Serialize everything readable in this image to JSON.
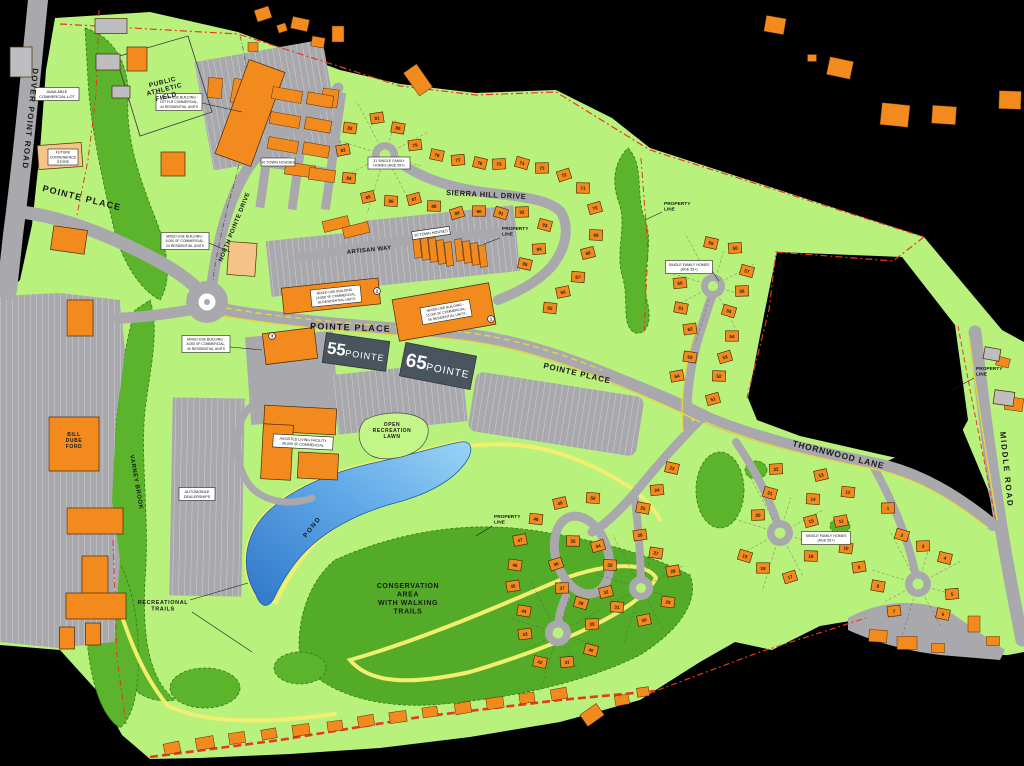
{
  "map_title": "Pointe Place Master Site Plan",
  "colors": {
    "background": "#000000",
    "site_green": "#b9f17d",
    "forest_green": "#5cb32c",
    "conservation_green": "#54ab28",
    "road_gray": "#a9a9ad",
    "stripe_white": "#d6d6da",
    "building_orange": "#f28a1e",
    "building_peach": "#f6c489",
    "building_gray": "#bdbdc2",
    "pond_blue_dark": "#2f77c8",
    "pond_blue_light": "#9bd4f5",
    "trail_yellow": "#f2ee70",
    "curb_yellow": "#e8d93a",
    "property_red": "#e8391f",
    "logo_slate": "#4a545e",
    "label_box": "#ffffff",
    "ink": "#1a1a1a"
  },
  "logos": [
    {
      "big": "55",
      "small": "POINTE",
      "x": 356,
      "y": 352,
      "w": 64,
      "h": 30,
      "rot": 8
    },
    {
      "big": "65",
      "small": "POINTE",
      "x": 438,
      "y": 366,
      "w": 72,
      "h": 34,
      "rot": 11
    }
  ],
  "road_labels": [
    {
      "id": "dover-point-road",
      "text": "DOVER POINT ROAD",
      "x": 33,
      "y": 68,
      "rot": 96,
      "size": 8,
      "ls": 1.3
    },
    {
      "id": "pointe-place-west",
      "text": "POINTE PLACE",
      "x": 42,
      "y": 191,
      "rot": 14,
      "size": 9,
      "ls": 1.2
    },
    {
      "id": "pointe-place-center",
      "text": "POINTE PLACE",
      "x": 310,
      "y": 329,
      "rot": 2,
      "size": 9,
      "ls": 1.2
    },
    {
      "id": "pointe-place-east",
      "text": "POINTE PLACE",
      "x": 543,
      "y": 368,
      "rot": 13,
      "size": 8,
      "ls": 0.8
    },
    {
      "id": "north-pointe-drive",
      "text": "NORTH POINTE DRIVE",
      "x": 222,
      "y": 262,
      "rot": -68,
      "size": 6,
      "ls": 0.5
    },
    {
      "id": "sierra-hill-drive",
      "text": "SIERRA HILL DRIVE",
      "x": 446,
      "y": 195,
      "rot": 3,
      "size": 7.5,
      "ls": 0.5
    },
    {
      "id": "artisan-way",
      "text": "ARTISAN WAY",
      "x": 347,
      "y": 254,
      "rot": -6,
      "size": 6,
      "ls": 0.3
    },
    {
      "id": "thornwood-lane",
      "text": "THORNWOOD LANE",
      "x": 792,
      "y": 446,
      "rot": 14,
      "size": 8.5,
      "ls": 0.8
    },
    {
      "id": "middle-road",
      "text": "MIDDLE ROAD",
      "x": 1000,
      "y": 432,
      "rot": 84,
      "size": 8,
      "ls": 1.8
    },
    {
      "id": "varney-brook",
      "text": "VARNEY BROOK",
      "x": 130,
      "y": 455,
      "rot": 80,
      "size": 6,
      "ls": 0.6
    },
    {
      "id": "pond",
      "text": "POND",
      "x": 306,
      "y": 538,
      "rot": -52,
      "size": 6.5,
      "ls": 1.5
    }
  ],
  "area_labels": [
    {
      "id": "public-athletic-field",
      "lines": [
        "PUBLIC",
        "ATHLETIC",
        "FIELD"
      ],
      "x": 163,
      "y": 84,
      "size": 6.5,
      "lh": 7.5,
      "rot": -14
    },
    {
      "id": "open-recreation-lawn",
      "lines": [
        "OPEN",
        "RECREATION",
        "LAWN"
      ],
      "x": 392,
      "y": 426,
      "size": 5,
      "lh": 6,
      "rot": 0
    },
    {
      "id": "conservation-area",
      "lines": [
        "CONSERVATION",
        "AREA",
        "WITH WALKING",
        "TRAILS"
      ],
      "x": 408,
      "y": 588,
      "size": 7,
      "lh": 8.5,
      "rot": 0
    },
    {
      "id": "recreational-trails",
      "lines": [
        "RECREATIONAL",
        "TRAILS"
      ],
      "x": 163,
      "y": 604,
      "size": 5.5,
      "lh": 6.5,
      "rot": 0
    },
    {
      "id": "bill-dube-ford",
      "lines": [
        "BILL",
        "DUBE",
        "FORD"
      ],
      "x": 74,
      "y": 436,
      "size": 5,
      "lh": 6,
      "rot": 0
    }
  ],
  "property_labels": [
    {
      "lines": [
        "PROPERTY",
        "LINE"
      ],
      "x": 664,
      "y": 205,
      "leader": [
        662,
        212,
        645,
        220
      ]
    },
    {
      "lines": [
        "PROPERTY",
        "LINE"
      ],
      "x": 502,
      "y": 230,
      "leader": [
        500,
        238,
        484,
        244
      ]
    },
    {
      "lines": [
        "PROPERTY",
        "LINE"
      ],
      "x": 494,
      "y": 518,
      "leader": [
        492,
        526,
        476,
        536
      ]
    },
    {
      "lines": [
        "PROPERTY",
        "LINE"
      ],
      "x": 976,
      "y": 370,
      "leader": [
        974,
        378,
        952,
        390
      ]
    }
  ],
  "boxed_labels": [
    {
      "id": "available-commercial-lot",
      "lines": [
        "AVAILABLE",
        "COMMERCIAL LOT"
      ],
      "x": 57,
      "y": 94,
      "w": 44,
      "h": 13,
      "s": 4,
      "rot": 0
    },
    {
      "id": "future-convenience-store",
      "lines": [
        "FUTURE",
        "CONVENIENCE",
        "STORE"
      ],
      "x": 63,
      "y": 157,
      "w": 30,
      "h": 16,
      "s": 3.6,
      "rot": 0
    },
    {
      "id": "mixed-use-44",
      "lines": [
        "MIXED-USE BUILDING -",
        "1ST FLR COMMERCIAL,",
        "44 RESIDENTIAL UNITS"
      ],
      "x": 179,
      "y": 102,
      "w": 46,
      "h": 17,
      "s": 3.4,
      "rot": 0
    },
    {
      "id": "sfh-31",
      "lines": [
        "31 SINGLE FAMILY",
        "HOMES (AGE 55+)"
      ],
      "x": 389,
      "y": 163,
      "w": 42,
      "h": 12,
      "s": 3.6,
      "rot": 0
    },
    {
      "id": "town-houses-10",
      "lines": [
        "10 TOWN HOUSES"
      ],
      "x": 278,
      "y": 162,
      "w": 34,
      "h": 8,
      "s": 3.8,
      "rot": 0
    },
    {
      "id": "town-houses-20",
      "lines": [
        "20 TOWN HOUSES"
      ],
      "x": 431,
      "y": 233,
      "w": 38,
      "h": 8,
      "s": 3.8,
      "rot": -8
    },
    {
      "id": "mixed-use-24",
      "lines": [
        "MIXED-USE BUILDING -",
        "5,000 SF COMMERCIAL,",
        "24 RESIDENTIAL UNITS"
      ],
      "x": 185,
      "y": 241,
      "w": 48,
      "h": 17,
      "s": 3.4,
      "rot": 0
    },
    {
      "id": "mixed-use-56-west",
      "lines": [
        "MIXED-USE BUILDING -",
        "15,000 SF COMMERCIAL,",
        "56 RESIDENTIAL UNITS"
      ],
      "x": 336,
      "y": 296,
      "w": 50,
      "h": 17,
      "s": 3.4,
      "rot": -6
    },
    {
      "id": "mixed-use-56-east",
      "lines": [
        "MIXED-USE BUILDING -",
        "15,000 SF COMMERCIAL,",
        "56 RESIDENTIAL UNITS"
      ],
      "x": 446,
      "y": 312,
      "w": 50,
      "h": 17,
      "s": 3.4,
      "rot": -10
    },
    {
      "id": "mixed-use-40",
      "lines": [
        "MIXED-USE BUILDING -",
        "8,000 SF COMMERCIAL,",
        "40 RESIDENTIAL UNITS"
      ],
      "x": 206,
      "y": 344,
      "w": 48,
      "h": 17,
      "s": 3.4,
      "rot": 0
    },
    {
      "id": "assisted-living",
      "lines": [
        "ASSISTED LIVING FACILITY",
        "38,000 SF COMMERCIAL"
      ],
      "x": 303,
      "y": 442,
      "w": 60,
      "h": 13,
      "s": 3.6,
      "rot": 3
    },
    {
      "id": "automobile-dealerships",
      "lines": [
        "AUTOMOBILE",
        "DEALERSHIPS"
      ],
      "x": 197,
      "y": 494,
      "w": 36,
      "h": 13,
      "s": 3.8,
      "rot": 0
    },
    {
      "id": "sfh-ne",
      "lines": [
        "SINGLE FAMILY HOMES",
        "(AGE 55+)"
      ],
      "x": 689,
      "y": 267,
      "w": 47,
      "h": 13,
      "s": 3.6,
      "rot": 0
    },
    {
      "id": "sfh-thornwood",
      "lines": [
        "SINGLE FAMILY HOMES",
        "(AGE 55+)"
      ],
      "x": 826,
      "y": 538,
      "w": 49,
      "h": 13,
      "s": 3.6,
      "rot": 0
    }
  ],
  "circled_numbers": [
    {
      "n": "1",
      "x": 491,
      "y": 319
    },
    {
      "n": "2",
      "x": 377,
      "y": 291
    },
    {
      "n": "3",
      "x": 272,
      "y": 336
    }
  ],
  "lots": [
    {
      "n": "1",
      "x": 888,
      "y": 508
    },
    {
      "n": "2",
      "x": 902,
      "y": 535
    },
    {
      "n": "3",
      "x": 923,
      "y": 546
    },
    {
      "n": "4",
      "x": 945,
      "y": 558
    },
    {
      "n": "5",
      "x": 952,
      "y": 594
    },
    {
      "n": "6",
      "x": 943,
      "y": 614
    },
    {
      "n": "7",
      "x": 894,
      "y": 611
    },
    {
      "n": "8",
      "x": 878,
      "y": 586
    },
    {
      "n": "9",
      "x": 859,
      "y": 567
    },
    {
      "n": "10",
      "x": 846,
      "y": 548
    },
    {
      "n": "11",
      "x": 841,
      "y": 521
    },
    {
      "n": "12",
      "x": 848,
      "y": 492
    },
    {
      "n": "13",
      "x": 821,
      "y": 475
    },
    {
      "n": "14",
      "x": 813,
      "y": 499
    },
    {
      "n": "15",
      "x": 811,
      "y": 521
    },
    {
      "n": "16",
      "x": 811,
      "y": 556
    },
    {
      "n": "17",
      "x": 790,
      "y": 577
    },
    {
      "n": "18",
      "x": 763,
      "y": 568
    },
    {
      "n": "19",
      "x": 745,
      "y": 556
    },
    {
      "n": "20",
      "x": 758,
      "y": 515
    },
    {
      "n": "21",
      "x": 770,
      "y": 493
    },
    {
      "n": "22",
      "x": 776,
      "y": 469
    },
    {
      "n": "23",
      "x": 672,
      "y": 468
    },
    {
      "n": "24",
      "x": 657,
      "y": 490
    },
    {
      "n": "25",
      "x": 643,
      "y": 508
    },
    {
      "n": "26",
      "x": 640,
      "y": 535
    },
    {
      "n": "27",
      "x": 656,
      "y": 553
    },
    {
      "n": "28",
      "x": 673,
      "y": 571
    },
    {
      "n": "29",
      "x": 668,
      "y": 602
    },
    {
      "n": "30",
      "x": 644,
      "y": 620
    },
    {
      "n": "31",
      "x": 617,
      "y": 607
    },
    {
      "n": "32",
      "x": 606,
      "y": 592
    },
    {
      "n": "33",
      "x": 610,
      "y": 565
    },
    {
      "n": "34",
      "x": 598,
      "y": 546
    },
    {
      "n": "35",
      "x": 573,
      "y": 541
    },
    {
      "n": "36",
      "x": 556,
      "y": 564
    },
    {
      "n": "37",
      "x": 562,
      "y": 588
    },
    {
      "n": "38",
      "x": 581,
      "y": 603
    },
    {
      "n": "39",
      "x": 592,
      "y": 624
    },
    {
      "n": "40",
      "x": 591,
      "y": 650
    },
    {
      "n": "41",
      "x": 567,
      "y": 662
    },
    {
      "n": "42",
      "x": 540,
      "y": 662
    },
    {
      "n": "43",
      "x": 525,
      "y": 634
    },
    {
      "n": "44",
      "x": 524,
      "y": 611
    },
    {
      "n": "45",
      "x": 513,
      "y": 586
    },
    {
      "n": "46",
      "x": 515,
      "y": 565
    },
    {
      "n": "47",
      "x": 520,
      "y": 540
    },
    {
      "n": "48",
      "x": 536,
      "y": 519
    },
    {
      "n": "49",
      "x": 560,
      "y": 503
    },
    {
      "n": "50",
      "x": 593,
      "y": 498
    },
    {
      "n": "51",
      "x": 713,
      "y": 399
    },
    {
      "n": "52",
      "x": 719,
      "y": 376
    },
    {
      "n": "53",
      "x": 725,
      "y": 357
    },
    {
      "n": "54",
      "x": 732,
      "y": 336
    },
    {
      "n": "55",
      "x": 729,
      "y": 311
    },
    {
      "n": "56",
      "x": 742,
      "y": 291
    },
    {
      "n": "57",
      "x": 747,
      "y": 271
    },
    {
      "n": "58",
      "x": 735,
      "y": 248
    },
    {
      "n": "59",
      "x": 711,
      "y": 243
    },
    {
      "n": "60",
      "x": 680,
      "y": 283
    },
    {
      "n": "61",
      "x": 681,
      "y": 308
    },
    {
      "n": "62",
      "x": 690,
      "y": 329
    },
    {
      "n": "63",
      "x": 690,
      "y": 357
    },
    {
      "n": "64",
      "x": 677,
      "y": 376
    },
    {
      "n": "65",
      "x": 550,
      "y": 308
    },
    {
      "n": "66",
      "x": 563,
      "y": 292
    },
    {
      "n": "67",
      "x": 578,
      "y": 277
    },
    {
      "n": "68",
      "x": 588,
      "y": 253
    },
    {
      "n": "69",
      "x": 596,
      "y": 235
    },
    {
      "n": "70",
      "x": 595,
      "y": 208
    },
    {
      "n": "71",
      "x": 583,
      "y": 188
    },
    {
      "n": "72",
      "x": 564,
      "y": 175
    },
    {
      "n": "73",
      "x": 542,
      "y": 168
    },
    {
      "n": "74",
      "x": 522,
      "y": 163
    },
    {
      "n": "75",
      "x": 499,
      "y": 164
    },
    {
      "n": "76",
      "x": 480,
      "y": 163
    },
    {
      "n": "77",
      "x": 458,
      "y": 160
    },
    {
      "n": "78",
      "x": 437,
      "y": 155
    },
    {
      "n": "79",
      "x": 415,
      "y": 145
    },
    {
      "n": "80",
      "x": 398,
      "y": 128
    },
    {
      "n": "81",
      "x": 377,
      "y": 118
    },
    {
      "n": "82",
      "x": 350,
      "y": 128
    },
    {
      "n": "83",
      "x": 343,
      "y": 150
    },
    {
      "n": "84",
      "x": 349,
      "y": 178
    },
    {
      "n": "85",
      "x": 368,
      "y": 197
    },
    {
      "n": "86",
      "x": 391,
      "y": 201
    },
    {
      "n": "87",
      "x": 414,
      "y": 199
    },
    {
      "n": "88",
      "x": 434,
      "y": 206
    },
    {
      "n": "89",
      "x": 457,
      "y": 213
    },
    {
      "n": "90",
      "x": 479,
      "y": 211
    },
    {
      "n": "91",
      "x": 501,
      "y": 213
    },
    {
      "n": "92",
      "x": 522,
      "y": 212
    },
    {
      "n": "93",
      "x": 545,
      "y": 225
    },
    {
      "n": "94",
      "x": 539,
      "y": 249
    },
    {
      "n": "95",
      "x": 525,
      "y": 264
    }
  ],
  "culdesacs": [
    {
      "x": 385,
      "y": 155,
      "r": 13
    },
    {
      "x": 713,
      "y": 286,
      "r": 12
    },
    {
      "x": 780,
      "y": 533,
      "r": 13
    },
    {
      "x": 918,
      "y": 584,
      "r": 13
    },
    {
      "x": 641,
      "y": 588,
      "r": 12
    },
    {
      "n": "",
      "x": 558,
      "y": 633,
      "r": 13
    }
  ],
  "buildings": [
    [
      250,
      113,
      38,
      100,
      20,
      "o"
    ],
    [
      331,
      296,
      97,
      26,
      -6,
      "o"
    ],
    [
      444,
      312,
      98,
      42,
      -10,
      "o"
    ],
    [
      290,
      346,
      52,
      31,
      -7,
      "o"
    ],
    [
      242,
      259,
      28,
      33,
      4,
      "p"
    ],
    [
      300,
      420,
      72,
      26,
      3,
      "o"
    ],
    [
      277,
      452,
      30,
      55,
      3,
      "o"
    ],
    [
      318,
      466,
      40,
      26,
      3,
      "o"
    ],
    [
      74,
      444,
      50,
      54,
      0,
      "o"
    ],
    [
      95,
      521,
      56,
      26,
      0,
      "o"
    ],
    [
      95,
      578,
      26,
      44,
      0,
      "o"
    ],
    [
      96,
      606,
      60,
      26,
      0,
      "o"
    ],
    [
      67,
      638,
      15,
      22,
      0,
      "o"
    ],
    [
      93,
      634,
      15,
      22,
      0,
      "o"
    ],
    [
      60,
      156,
      44,
      24,
      -4,
      "p"
    ],
    [
      137,
      59,
      20,
      24,
      0,
      "o"
    ],
    [
      173,
      164,
      24,
      24,
      0,
      "o"
    ],
    [
      69,
      240,
      34,
      24,
      8,
      "o"
    ],
    [
      80,
      318,
      26,
      36,
      0,
      "o"
    ],
    [
      111,
      26,
      32,
      15,
      0,
      "g"
    ],
    [
      108,
      62,
      24,
      16,
      0,
      "g"
    ],
    [
      121,
      92,
      18,
      12,
      0,
      "g"
    ],
    [
      21,
      62,
      22,
      30,
      0,
      "g"
    ],
    [
      992,
      354,
      16,
      12,
      10,
      "g"
    ],
    [
      1004,
      398,
      20,
      14,
      8,
      "g"
    ]
  ],
  "townhouses": [
    [
      287,
      95,
      30,
      12,
      10
    ],
    [
      285,
      120,
      30,
      12,
      10
    ],
    [
      283,
      145,
      30,
      12,
      10
    ],
    [
      300,
      170,
      30,
      12,
      8
    ],
    [
      320,
      100,
      26,
      12,
      10
    ],
    [
      318,
      125,
      26,
      12,
      10
    ],
    [
      316,
      150,
      26,
      12,
      10
    ],
    [
      322,
      175,
      26,
      12,
      8
    ],
    [
      417,
      246,
      7,
      24,
      -6
    ],
    [
      425,
      248,
      7,
      24,
      -6
    ],
    [
      433,
      250,
      7,
      24,
      -6
    ],
    [
      441,
      252,
      7,
      24,
      -6
    ],
    [
      449,
      254,
      7,
      24,
      -6
    ],
    [
      459,
      250,
      7,
      22,
      -6
    ],
    [
      467,
      252,
      7,
      22,
      -6
    ],
    [
      475,
      254,
      7,
      22,
      -6
    ],
    [
      483,
      256,
      7,
      22,
      -6
    ],
    [
      336,
      224,
      26,
      11,
      -14
    ],
    [
      356,
      230,
      26,
      11,
      -14
    ]
  ],
  "offsite_buildings": [
    [
      263,
      14,
      15,
      12,
      -18
    ],
    [
      282,
      28,
      9,
      8,
      -18
    ],
    [
      300,
      24,
      17,
      12,
      12
    ],
    [
      318,
      42,
      13,
      10,
      10
    ],
    [
      338,
      34,
      12,
      16,
      0
    ],
    [
      253,
      47,
      10,
      9,
      0
    ],
    [
      215,
      88,
      14,
      20,
      4
    ],
    [
      243,
      92,
      22,
      24,
      10
    ],
    [
      330,
      98,
      16,
      18,
      8
    ],
    [
      418,
      80,
      16,
      28,
      -35
    ],
    [
      775,
      25,
      20,
      16,
      10
    ],
    [
      812,
      58,
      9,
      7,
      0
    ],
    [
      840,
      68,
      24,
      18,
      12
    ],
    [
      895,
      115,
      28,
      22,
      6
    ],
    [
      944,
      115,
      24,
      18,
      4
    ],
    [
      1010,
      100,
      22,
      18,
      2
    ],
    [
      1003,
      362,
      13,
      9,
      15
    ],
    [
      1014,
      404,
      18,
      13,
      8
    ],
    [
      878,
      636,
      18,
      12,
      3
    ],
    [
      907,
      643,
      20,
      13,
      0
    ],
    [
      938,
      648,
      13,
      9,
      0
    ],
    [
      974,
      624,
      12,
      16,
      0
    ],
    [
      993,
      641,
      13,
      9,
      0
    ],
    [
      172,
      748,
      16,
      11,
      -12
    ],
    [
      205,
      743,
      18,
      12,
      -10
    ],
    [
      237,
      738,
      16,
      11,
      -8
    ],
    [
      269,
      734,
      15,
      10,
      -10
    ],
    [
      301,
      730,
      17,
      11,
      -8
    ],
    [
      335,
      726,
      15,
      10,
      -8
    ],
    [
      366,
      721,
      16,
      11,
      -10
    ],
    [
      398,
      717,
      17,
      11,
      -8
    ],
    [
      430,
      712,
      15,
      10,
      -8
    ],
    [
      463,
      708,
      16,
      11,
      -10
    ],
    [
      495,
      703,
      17,
      11,
      -8
    ],
    [
      527,
      698,
      15,
      10,
      -8
    ],
    [
      559,
      694,
      16,
      11,
      -10
    ],
    [
      592,
      715,
      20,
      14,
      -35
    ],
    [
      622,
      700,
      14,
      10,
      -10
    ],
    [
      643,
      692,
      12,
      9,
      -8
    ]
  ],
  "leader_lines": [
    [
      202,
      103,
      242,
      112
    ],
    [
      209,
      243,
      230,
      252
    ],
    [
      230,
      347,
      262,
      350
    ],
    [
      712,
      271,
      719,
      281
    ],
    [
      190,
      600,
      248,
      583
    ],
    [
      192,
      612,
      252,
      652
    ]
  ]
}
